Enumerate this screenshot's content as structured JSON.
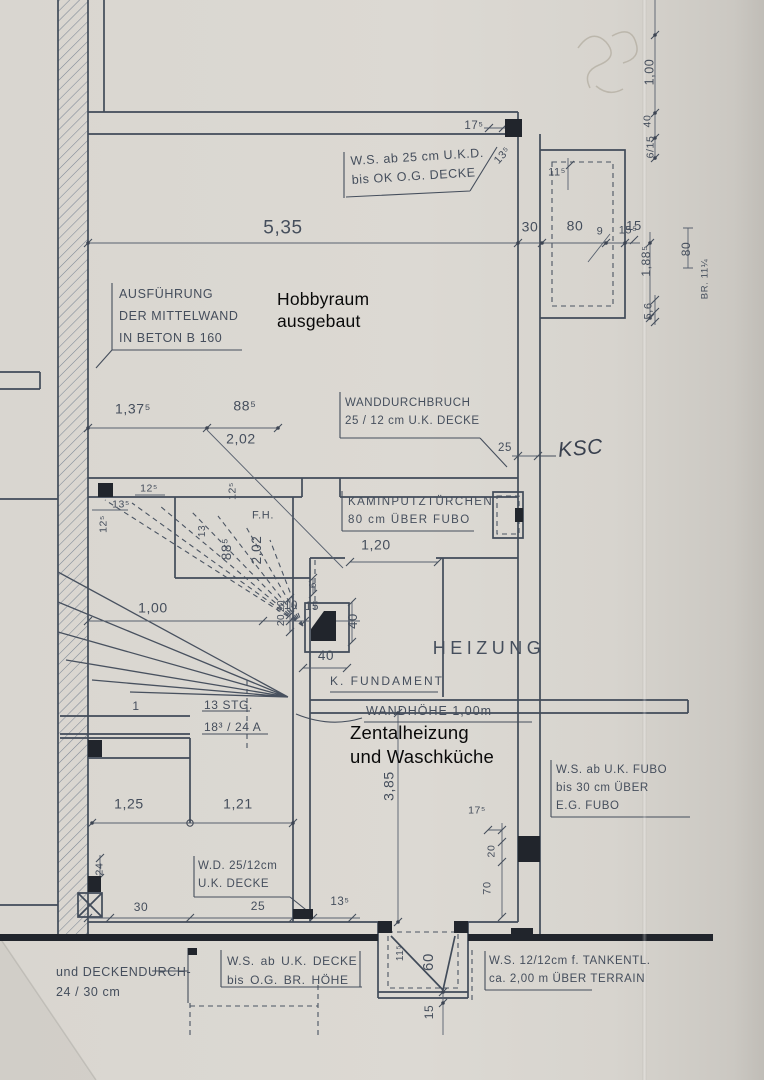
{
  "plan": {
    "notes": {
      "ws_ukd": "W.S. ab 25 cm U.K.D.\nbis OK O.G. DECKE",
      "ausfuehrung": "AUSFÜHRUNG\nDER MITTELWAND\nIN BETON B 160",
      "hobbyraum": "Hobbyraum\nausgebaut",
      "wanddurchbruch": "WANDDURCHBRUCH\n25 / 12 cm U.K. DECKE",
      "ksc": "KSC",
      "kaminputz": "KAMINPUTZTÜRCHEN\n80 cm ÜBER FUBO",
      "fh": "F.H.",
      "heizung": "HEIZUNG",
      "k_fundament": "K. FUNDAMENT",
      "wandhoehe": "WANDHÖHE 1,00m",
      "zentralheizung": "Zentalheizung\nund Waschküche",
      "stg": "13 STG.\n18³ / 24 A",
      "one": "1",
      "wd_decke": "W.D. 25/12cm\nU.K. DECKE",
      "ws_fubo": "W.S. ab U.K. FUBO\nbis 30 cm ÜBER\nE.G. FUBO",
      "ws_decke_og": "W.S. ab U.K. DECKE\nbis O.G. BR. HÖHE",
      "ws_tank": "W.S. 12/12cm f. TANKENTL.\nca. 2,00 m ÜBER TERRAIN",
      "deckendurch": "und DECKENDURCH-\n24  / 30 cm"
    },
    "dims": {
      "w535": "5,35",
      "w30": "30",
      "w80": "80",
      "w15": "15",
      "w9": "9",
      "top175": "17⁵",
      "top135": "13⁵",
      "top115": "11⁵",
      "r100": "1,00",
      "r40": "40",
      "r615": "6/15",
      "r155": "15⁵",
      "r1885": "1,88⁵",
      "r80": "80",
      "rbr": "BR. 11¼",
      "r56": "5,6",
      "m1375": "1,37⁵",
      "m885": "88⁵",
      "m202": "2,02",
      "m25": "25",
      "s125a": "12⁵",
      "s135": "13⁵",
      "s125b": "12⁵",
      "s125c": "12⁵",
      "s13": "13",
      "s885": "88⁵",
      "s202": "2,02",
      "k120": "1,20",
      "k6": "6",
      "k20a": "20",
      "k20b": "20",
      "k40v": "40",
      "k40h": "40",
      "f100": "1,00",
      "f10": "10",
      "f15": "15",
      "v385": "3,85",
      "b125": "1,25",
      "b121": "1,21",
      "b24": "24",
      "b30": "30",
      "b25": "25",
      "b135": "13⁵",
      "e175": "17⁵",
      "e20": "20",
      "e70": "70",
      "g115": "11⁵",
      "g60": "60",
      "g15": "15"
    }
  },
  "colors": {
    "ink": "#454e5c",
    "paper": "#dbd8d2",
    "overlay_text": "#0a0a0a"
  }
}
